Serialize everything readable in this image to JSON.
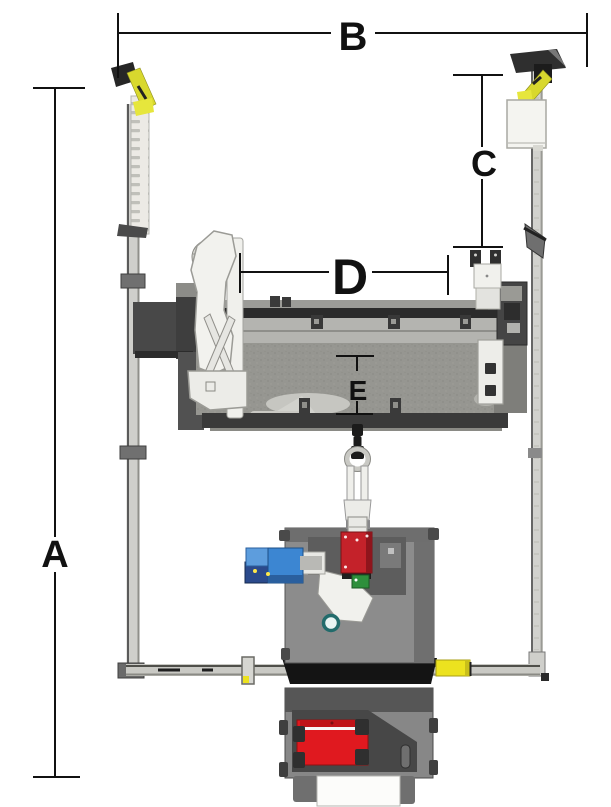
{
  "diagram": {
    "type": "dimension-drawing-top-view",
    "labels": {
      "a": "A",
      "b": "B",
      "c": "C",
      "d": "D",
      "e": "E"
    }
  },
  "colors": {
    "line": "#111111",
    "sensor_yellow": "#d8d82e",
    "sensor_yellow_bright": "#e6e63c",
    "rail_yellow": "#ece21f",
    "rail_yellow_cap": "#c9bf1a",
    "engine_red": "#c4222a",
    "panel_red": "#e0191f",
    "panel_red_dark": "#c01318",
    "hose_blue": "#3c86d2",
    "light_blue": "#5d9ddd",
    "navy_blue": "#2b4a8c",
    "pcb_green": "#2e8f3c",
    "teal": "#226b6b",
    "dot_yellow": "#ffe84a"
  }
}
